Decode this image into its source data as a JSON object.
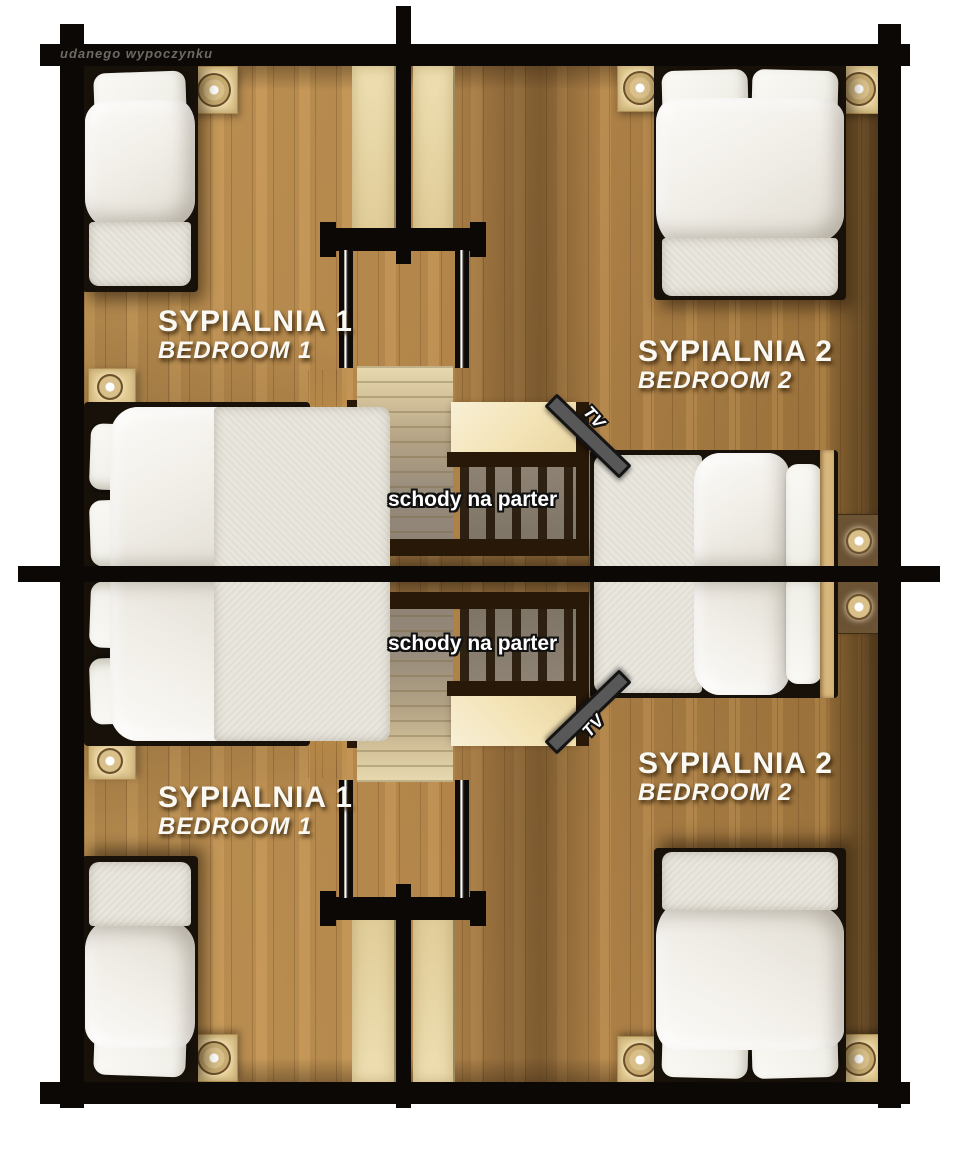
{
  "watermark": "udanego wypoczynku",
  "rooms": {
    "bedroom1": {
      "pl": "SYPIALNIA 1",
      "en": "BEDROOM 1"
    },
    "bedroom2": {
      "pl": "SYPIALNIA 2",
      "en": "BEDROOM 2"
    }
  },
  "stairs": {
    "label": "schody na parter"
  },
  "tv": {
    "label": "TV"
  },
  "colors": {
    "wall": "#0b0805",
    "floor": "#bc8c4e",
    "floor_light": "#c79a58",
    "corridor_gold": "#c8964a",
    "knee_wall": "#e6d2a0",
    "landing": "#f3e3b5",
    "stair_top": "#e8d9b0",
    "stair_bottom": "#8d8274",
    "railing": "#271808",
    "tv_gray": "#585858",
    "bedding": "#f3f1ec",
    "label_text": "#faf8f2"
  }
}
